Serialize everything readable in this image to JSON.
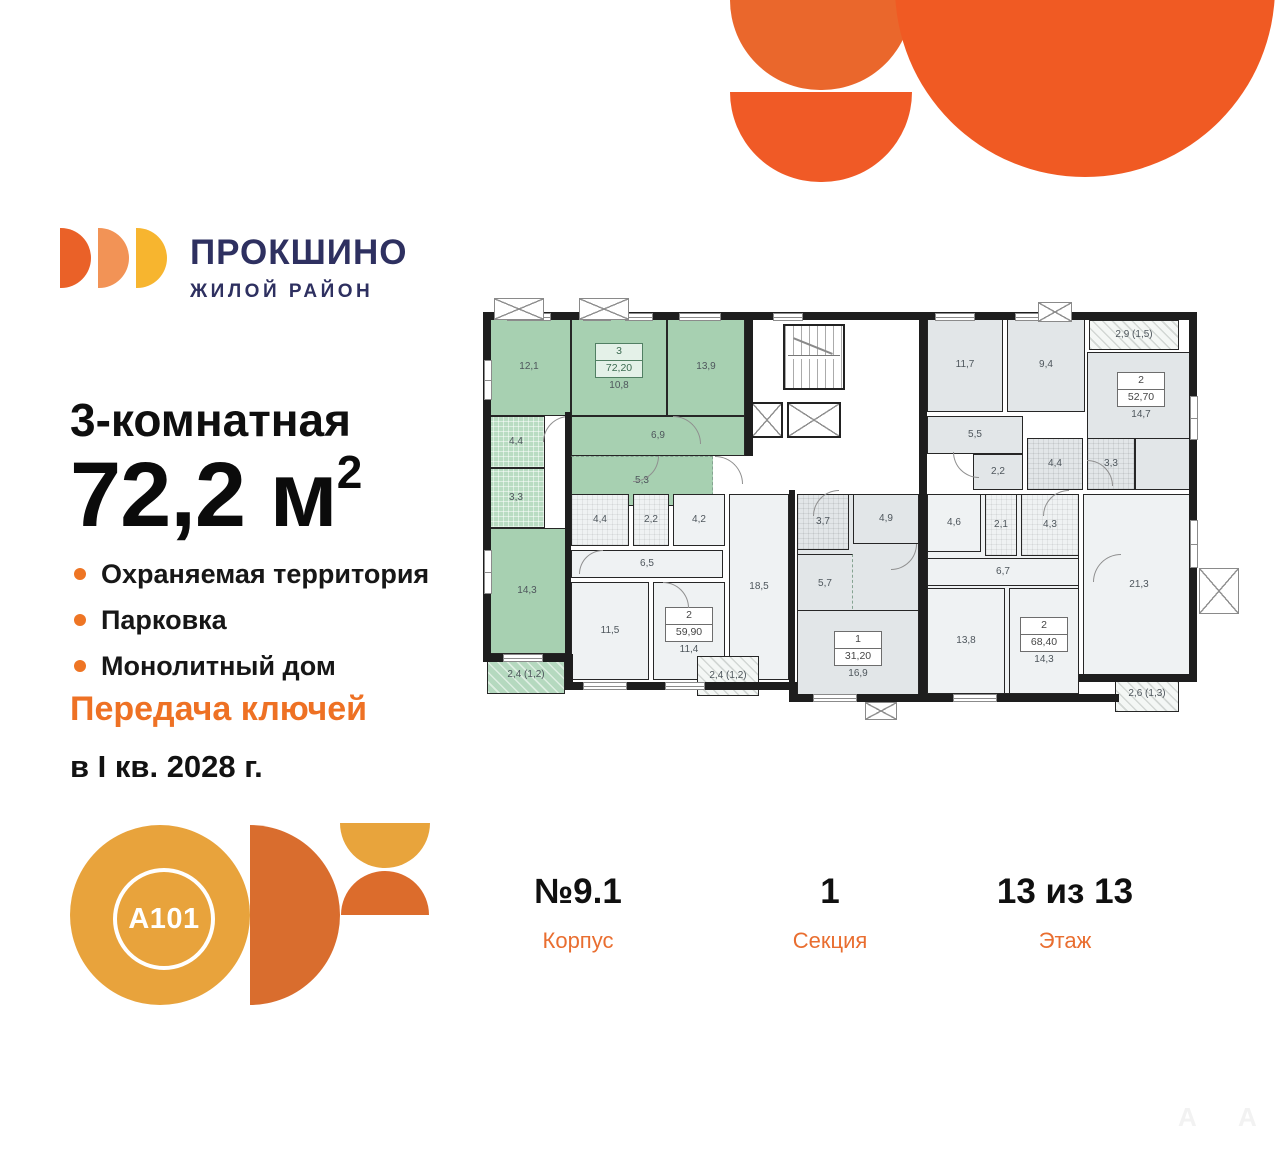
{
  "brand": {
    "name": "ПРОКШИНО",
    "tagline": "ЖИЛОЙ РАЙОН",
    "navy": "#2e3060",
    "petal_colors": [
      "#ea6128",
      "#f29356",
      "#f7b52f"
    ]
  },
  "accent_orange": "#ee7124",
  "listing": {
    "title": "3-комнатная",
    "area_text": "72,2 м",
    "area_sup": "2",
    "features": [
      "Охраняемая территория",
      "Парковка",
      "Монолитный дом"
    ],
    "handover_line1": "Передача ключей",
    "handover_line2": "в I кв. 2028 г."
  },
  "stats": [
    {
      "value": "№9.1",
      "label": "Корпус"
    },
    {
      "value": "1",
      "label": "Секция"
    },
    {
      "value": "13 из 13",
      "label": "Этаж"
    }
  ],
  "developer": {
    "logo_text": "A101"
  },
  "watermark": [
    "А",
    "А"
  ],
  "floorplan": {
    "highlight_color": "#a7d0b1",
    "gray_color": "#e2e6e8",
    "white_color": "#eff2f3",
    "wall_color": "#1e1e1e",
    "apartments": [
      {
        "rooms_type": "3",
        "total_area": "72,20",
        "highlighted": true
      },
      {
        "rooms_type": "2",
        "total_area": "59,90",
        "highlighted": false
      },
      {
        "rooms_type": "1",
        "total_area": "31,20",
        "highlighted": false
      },
      {
        "rooms_type": "2",
        "total_area": "68,40",
        "highlighted": false
      },
      {
        "rooms_type": "2",
        "total_area": "52,70",
        "highlighted": false
      }
    ],
    "rooms": [
      {
        "label": "12,1",
        "x": 4,
        "y": 14,
        "w": 84,
        "h": 98,
        "cls": "g"
      },
      {
        "label": "10,8",
        "x": 88,
        "y": 14,
        "w": 96,
        "h": 98,
        "cls": "g",
        "badge": {
          "num": "3",
          "area": "72,20",
          "acc": true
        }
      },
      {
        "label": "13,9",
        "x": 184,
        "y": 14,
        "w": 78,
        "h": 98,
        "cls": "g"
      },
      {
        "label": "6,9",
        "x": 88,
        "y": 112,
        "w": 174,
        "h": 40,
        "cls": "g"
      },
      {
        "label": "5,3",
        "x": 88,
        "y": 152,
        "w": 142,
        "h": 50,
        "cls": "g",
        "dash": [
          "t",
          "r"
        ]
      },
      {
        "label": "4,4",
        "x": 4,
        "y": 112,
        "w": 58,
        "h": 52,
        "cls": "gt"
      },
      {
        "label": "3,3",
        "x": 4,
        "y": 164,
        "w": 58,
        "h": 60,
        "cls": "gt"
      },
      {
        "label": "14,3",
        "x": 4,
        "y": 224,
        "w": 80,
        "h": 126,
        "cls": "g"
      },
      {
        "label": "2,4 (1,2)",
        "x": 4,
        "y": 352,
        "w": 78,
        "h": 38,
        "cls": "bgl"
      },
      {
        "label": "4,4",
        "x": 88,
        "y": 190,
        "w": 58,
        "h": 52,
        "cls": "wt"
      },
      {
        "label": "2,2",
        "x": 150,
        "y": 190,
        "w": 36,
        "h": 52,
        "cls": "wt"
      },
      {
        "label": "4,2",
        "x": 190,
        "y": 190,
        "w": 52,
        "h": 52,
        "cls": "w"
      },
      {
        "label": "6,5",
        "x": 88,
        "y": 246,
        "w": 152,
        "h": 28,
        "cls": "w"
      },
      {
        "label": "11,5",
        "x": 88,
        "y": 278,
        "w": 78,
        "h": 98,
        "cls": "w"
      },
      {
        "label": "11,4",
        "x": 170,
        "y": 278,
        "w": 72,
        "h": 98,
        "cls": "w",
        "badge": {
          "num": "2",
          "area": "59,90"
        }
      },
      {
        "label": "18,5",
        "x": 246,
        "y": 190,
        "w": 60,
        "h": 186,
        "cls": "w"
      },
      {
        "label": "2,4 (1,2)",
        "x": 214,
        "y": 352,
        "w": 62,
        "h": 40,
        "cls": "bal"
      },
      {
        "label": "",
        "x": 314,
        "y": 190,
        "w": 122,
        "h": 200,
        "cls": "gr"
      },
      {
        "label": "4,9",
        "x": 370,
        "y": 190,
        "w": 66,
        "h": 50,
        "cls": "gr"
      },
      {
        "label": "3,7",
        "x": 314,
        "y": 190,
        "w": 52,
        "h": 56,
        "cls": "grt"
      },
      {
        "label": "5,7",
        "x": 314,
        "y": 250,
        "w": 56,
        "h": 60,
        "cls": "gr",
        "dash": [
          "r"
        ]
      },
      {
        "label": "16,9",
        "x": 314,
        "y": 306,
        "w": 122,
        "h": 90,
        "cls": "gr",
        "badge": {
          "num": "1",
          "area": "31,20"
        }
      },
      {
        "label": "",
        "x": 444,
        "y": 190,
        "w": 152,
        "h": 200,
        "cls": "w"
      },
      {
        "label": "4,6",
        "x": 444,
        "y": 190,
        "w": 54,
        "h": 58,
        "cls": "w"
      },
      {
        "label": "2,1",
        "x": 502,
        "y": 190,
        "w": 32,
        "h": 62,
        "cls": "wt"
      },
      {
        "label": "4,3",
        "x": 538,
        "y": 190,
        "w": 58,
        "h": 62,
        "cls": "wt"
      },
      {
        "label": "6,7",
        "x": 444,
        "y": 254,
        "w": 152,
        "h": 28,
        "cls": "w"
      },
      {
        "label": "13,8",
        "x": 444,
        "y": 284,
        "w": 78,
        "h": 106,
        "cls": "w"
      },
      {
        "label": "14,3",
        "x": 526,
        "y": 284,
        "w": 70,
        "h": 106,
        "cls": "w",
        "badge": {
          "num": "2",
          "area": "68,40"
        }
      },
      {
        "label": "21,3",
        "x": 600,
        "y": 190,
        "w": 112,
        "h": 182,
        "cls": "w"
      },
      {
        "label": "2,6 (1,3)",
        "x": 632,
        "y": 372,
        "w": 64,
        "h": 36,
        "cls": "bal"
      },
      {
        "label": "11,7",
        "x": 444,
        "y": 14,
        "w": 76,
        "h": 94,
        "cls": "gr"
      },
      {
        "label": "9,4",
        "x": 524,
        "y": 14,
        "w": 78,
        "h": 94,
        "cls": "gr"
      },
      {
        "label": "2,9 (1,5)",
        "x": 606,
        "y": 16,
        "w": 90,
        "h": 30,
        "cls": "bal"
      },
      {
        "label": "14,7",
        "x": 604,
        "y": 48,
        "w": 108,
        "h": 88,
        "cls": "gr",
        "badge": {
          "num": "2",
          "area": "52,70"
        }
      },
      {
        "label": "",
        "x": 652,
        "y": 134,
        "w": 60,
        "h": 52,
        "cls": "gr"
      },
      {
        "label": "5,5",
        "x": 444,
        "y": 112,
        "w": 96,
        "h": 38,
        "cls": "gr"
      },
      {
        "label": "2,2",
        "x": 490,
        "y": 150,
        "w": 50,
        "h": 36,
        "cls": "gr"
      },
      {
        "label": "4,4",
        "x": 544,
        "y": 134,
        "w": 56,
        "h": 52,
        "cls": "grt"
      },
      {
        "label": "3,3",
        "x": 604,
        "y": 134,
        "w": 48,
        "h": 52,
        "cls": "grt"
      }
    ],
    "walls": [
      {
        "x": 0,
        "y": 8,
        "w": 714,
        "h": 8
      },
      {
        "x": 0,
        "y": 8,
        "w": 8,
        "h": 350
      },
      {
        "x": 706,
        "y": 8,
        "w": 8,
        "h": 370
      },
      {
        "x": 0,
        "y": 350,
        "w": 90,
        "h": 8
      },
      {
        "x": 82,
        "y": 350,
        "w": 8,
        "h": 34
      },
      {
        "x": 82,
        "y": 378,
        "w": 232,
        "h": 8
      },
      {
        "x": 306,
        "y": 378,
        "w": 8,
        "h": 18
      },
      {
        "x": 306,
        "y": 390,
        "w": 330,
        "h": 8
      },
      {
        "x": 596,
        "y": 370,
        "w": 118,
        "h": 8
      },
      {
        "x": 262,
        "y": 8,
        "w": 8,
        "h": 144
      },
      {
        "x": 82,
        "y": 108,
        "w": 6,
        "h": 248
      },
      {
        "x": 436,
        "y": 8,
        "w": 8,
        "h": 178
      },
      {
        "x": 306,
        "y": 186,
        "w": 6,
        "h": 196
      },
      {
        "x": 436,
        "y": 186,
        "w": 8,
        "h": 204
      }
    ],
    "windows": [
      {
        "x": 24,
        "y": 9,
        "w": 44,
        "h": 8
      },
      {
        "x": 100,
        "y": 9,
        "w": 28,
        "h": 8
      },
      {
        "x": 142,
        "y": 9,
        "w": 28,
        "h": 8
      },
      {
        "x": 196,
        "y": 9,
        "w": 42,
        "h": 8
      },
      {
        "x": 290,
        "y": 9,
        "w": 30,
        "h": 8
      },
      {
        "x": 452,
        "y": 9,
        "w": 40,
        "h": 8
      },
      {
        "x": 532,
        "y": 9,
        "w": 40,
        "h": 8
      },
      {
        "x": 1,
        "y": 56,
        "w": 8,
        "h": 40
      },
      {
        "x": 1,
        "y": 246,
        "w": 8,
        "h": 44
      },
      {
        "x": 707,
        "y": 92,
        "w": 8,
        "h": 44
      },
      {
        "x": 707,
        "y": 216,
        "w": 8,
        "h": 48
      },
      {
        "x": 100,
        "y": 378,
        "w": 44,
        "h": 8
      },
      {
        "x": 182,
        "y": 378,
        "w": 40,
        "h": 8
      },
      {
        "x": 330,
        "y": 390,
        "w": 44,
        "h": 8
      },
      {
        "x": 470,
        "y": 390,
        "w": 44,
        "h": 8
      },
      {
        "x": 20,
        "y": 350,
        "w": 40,
        "h": 8
      }
    ],
    "crosses": [
      {
        "x": 11,
        "y": -6,
        "w": 50,
        "h": 22
      },
      {
        "x": 96,
        "y": -6,
        "w": 50,
        "h": 22
      },
      {
        "x": 555,
        "y": -2,
        "w": 34,
        "h": 20
      },
      {
        "x": 382,
        "y": 398,
        "w": 32,
        "h": 18
      },
      {
        "x": 716,
        "y": 264,
        "w": 40,
        "h": 46
      }
    ],
    "arcs": [
      {
        "x": 190,
        "y": 112,
        "r": 28,
        "rot": 90
      },
      {
        "x": 60,
        "y": 112,
        "r": 26,
        "rot": 0
      },
      {
        "x": 150,
        "y": 152,
        "r": 26,
        "rot": 180
      },
      {
        "x": 232,
        "y": 152,
        "r": 28,
        "rot": 90
      },
      {
        "x": 96,
        "y": 246,
        "r": 24,
        "rot": 0
      },
      {
        "x": 180,
        "y": 278,
        "r": 26,
        "rot": 90
      },
      {
        "x": 330,
        "y": 186,
        "r": 26,
        "rot": 0
      },
      {
        "x": 408,
        "y": 240,
        "r": 26,
        "rot": 180
      },
      {
        "x": 470,
        "y": 148,
        "r": 26,
        "rot": 270
      },
      {
        "x": 560,
        "y": 186,
        "r": 26,
        "rot": 0
      },
      {
        "x": 604,
        "y": 156,
        "r": 26,
        "rot": 90
      },
      {
        "x": 610,
        "y": 250,
        "r": 28,
        "rot": 0
      }
    ],
    "stairs": {
      "x": 300,
      "y": 20,
      "w": 62,
      "h": 66
    },
    "elevators": [
      {
        "x": 268,
        "y": 98,
        "w": 32,
        "h": 36
      },
      {
        "x": 304,
        "y": 98,
        "w": 54,
        "h": 36
      }
    ]
  }
}
